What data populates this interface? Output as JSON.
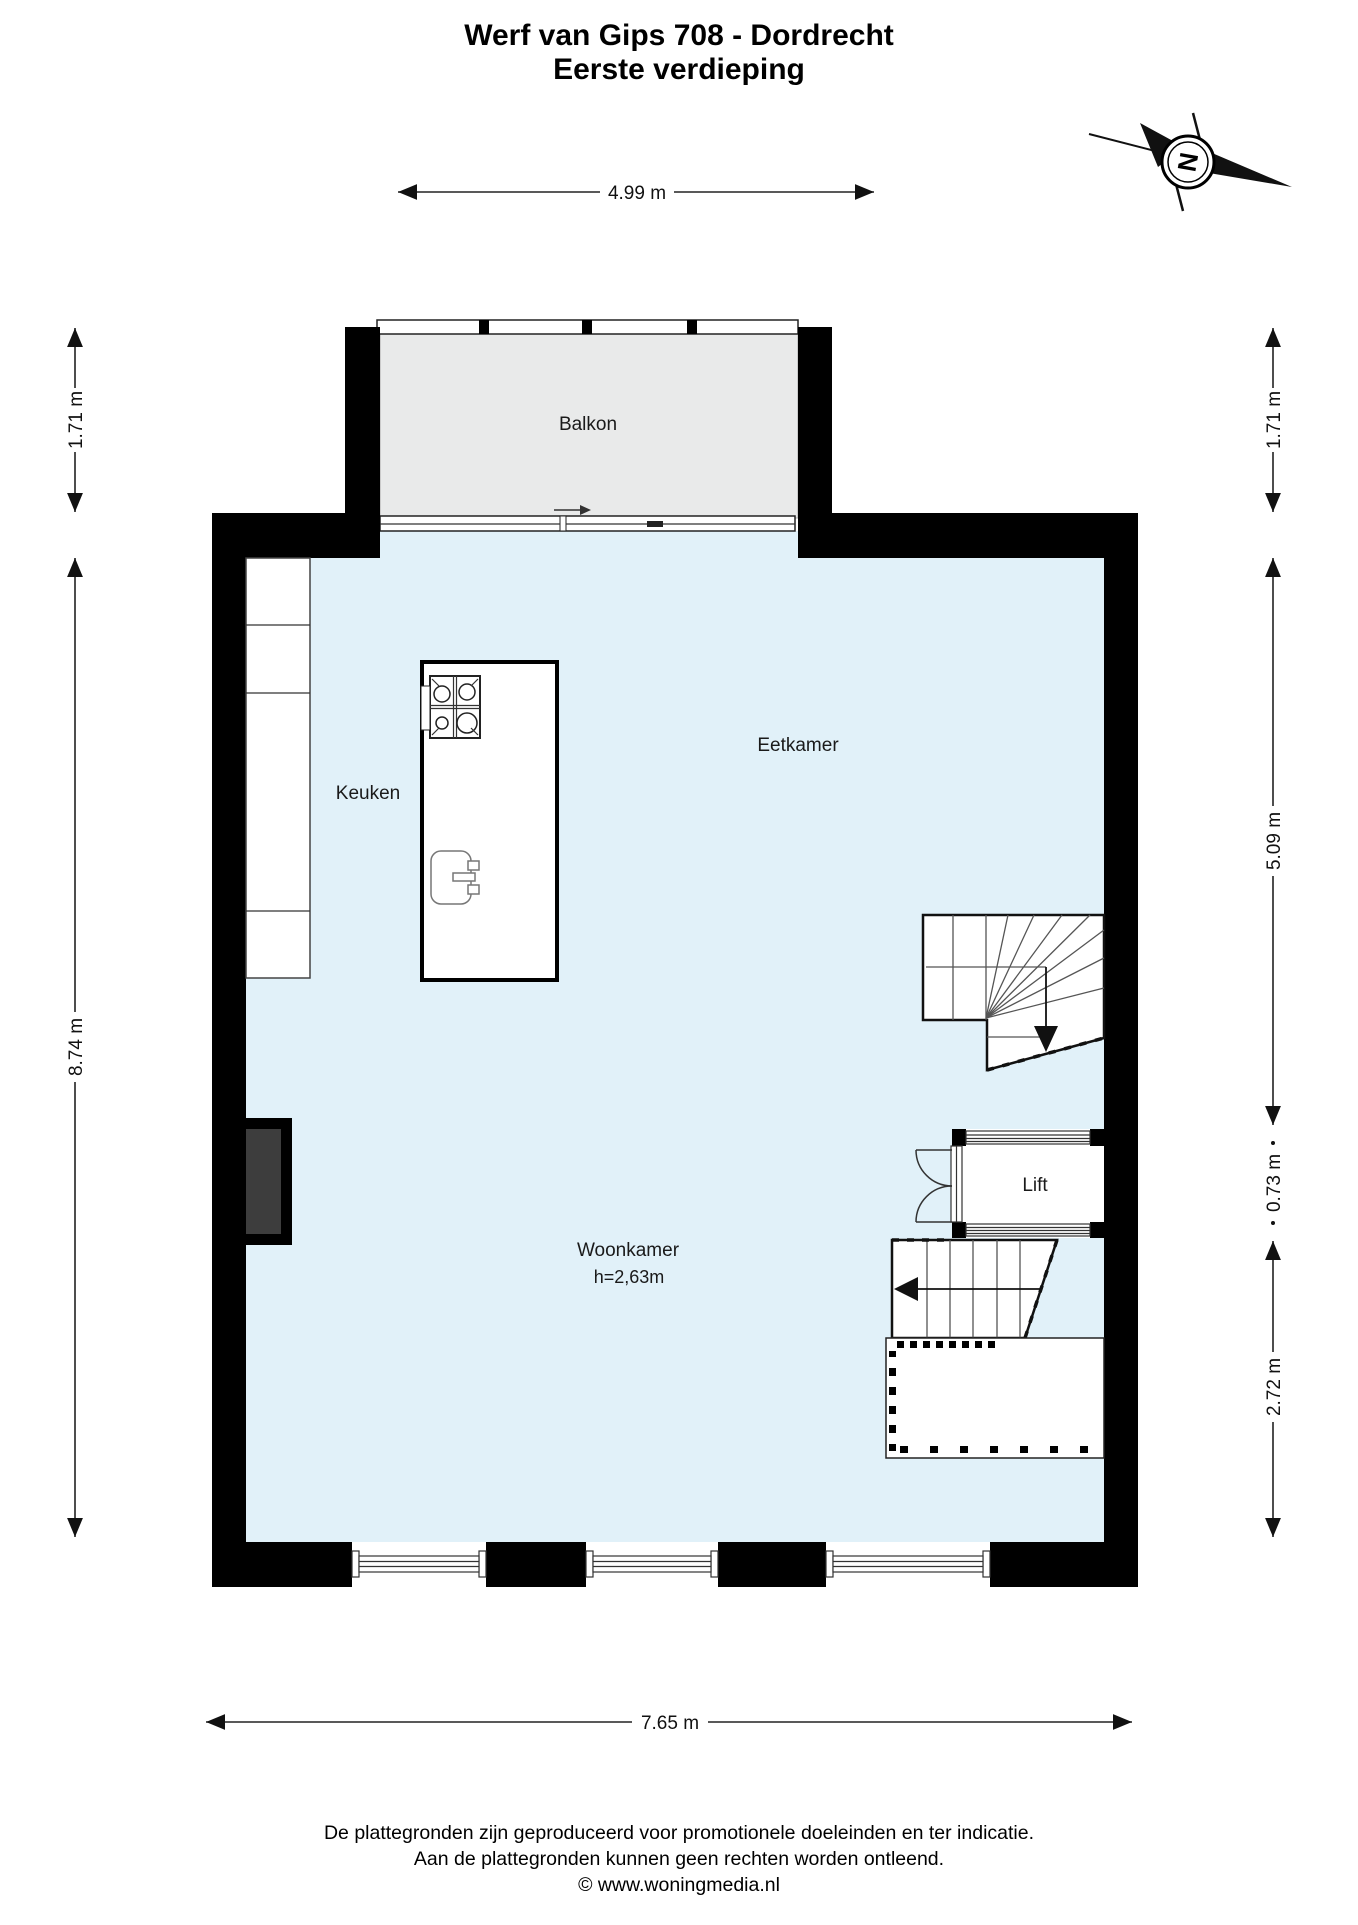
{
  "header": {
    "title_line1": "Werf van Gips 708 - Dordrecht",
    "title_line2": "Eerste verdieping"
  },
  "compass": {
    "label": "N"
  },
  "rooms": {
    "balkon": "Balkon",
    "keuken": "Keuken",
    "eetkamer": "Eetkamer",
    "woonkamer": "Woonkamer",
    "woonkamer_height": "h=2,63m",
    "lift": "Lift"
  },
  "dimensions": {
    "top_width": "4.99 m",
    "bottom_width": "7.65 m",
    "balcony_depth_left": "1.71 m",
    "room_height_left": "8.74 m",
    "balcony_depth_right": "1.71 m",
    "upper_section_right": "5.09 m",
    "lift_section_right": "0.73 m",
    "lower_section_right": "2.72 m"
  },
  "footer": {
    "line1": "De plattegronden zijn geproduceerd voor promotionele doeleinden en ter indicatie.",
    "line2": "Aan de plattegronden kunnen geen rechten worden ontleend.",
    "line3": "© www.woningmedia.nl"
  },
  "colors": {
    "floor": "#e1f1f9",
    "balcony": "#e9eaea",
    "wall": "#000000",
    "shaft": "#3d3d3d"
  }
}
